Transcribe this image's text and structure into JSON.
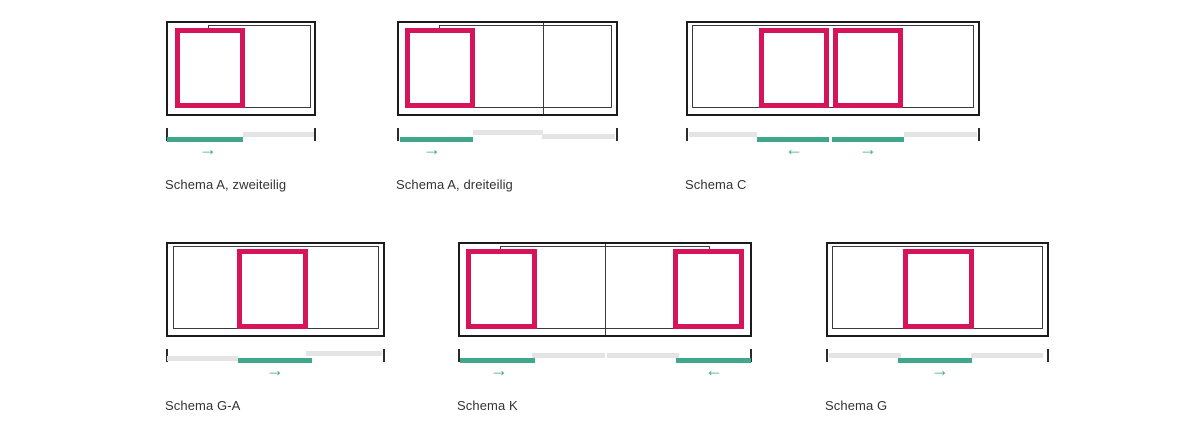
{
  "colors": {
    "panel": "#d6145a",
    "accent": "#40a78c",
    "rail_inactive": "#e4e4e4",
    "frame": "#1b1b1b",
    "outline": "#3b3b3b",
    "tick": "#2b2b2b",
    "label": "#333333",
    "background": "#ffffff"
  },
  "icons": {
    "arrow_right": "→",
    "arrow_left": "←"
  },
  "diagrams": [
    {
      "name": "schema-a-zweiteilig",
      "label": "Schema A, zweiteilig",
      "x": 166,
      "y": 21,
      "width": 150,
      "outline": {
        "x": 40,
        "w": 103
      },
      "dividers": [],
      "panels": [
        {
          "x": 7,
          "w": 70
        }
      ],
      "rails": [
        {
          "state": "active",
          "x": 1,
          "w": 76,
          "dy": 9
        },
        {
          "state": "inactive",
          "x": 77,
          "w": 71,
          "dy": 4
        }
      ],
      "arrows": [
        {
          "dir": "right",
          "cx": 42
        }
      ]
    },
    {
      "name": "schema-a-dreiteilig",
      "label": "Schema A, dreiteilig",
      "x": 397,
      "y": 21,
      "width": 221,
      "outline": {
        "x": 40,
        "w": 173
      },
      "dividers": [
        144
      ],
      "panels": [
        {
          "x": 6,
          "w": 70
        }
      ],
      "rails": [
        {
          "state": "active",
          "x": 3,
          "w": 73,
          "dy": 9
        },
        {
          "state": "inactive",
          "x": 76,
          "w": 70,
          "dy": 2
        },
        {
          "state": "inactive",
          "x": 145,
          "w": 73,
          "dy": 6
        }
      ],
      "arrows": [
        {
          "dir": "right",
          "cx": 35
        }
      ]
    },
    {
      "name": "schema-c",
      "label": "Schema C",
      "x": 686,
      "y": 21,
      "width": 294,
      "outline": {
        "x": 4,
        "w": 282
      },
      "dividers": [],
      "panels": [
        {
          "x": 71,
          "w": 70
        },
        {
          "x": 145,
          "w": 70
        }
      ],
      "rails": [
        {
          "state": "inactive",
          "x": 3,
          "w": 68,
          "dy": 4
        },
        {
          "state": "active",
          "x": 71,
          "w": 72,
          "dy": 9
        },
        {
          "state": "active",
          "x": 146,
          "w": 72,
          "dy": 9
        },
        {
          "state": "inactive",
          "x": 218,
          "w": 73,
          "dy": 4
        }
      ],
      "arrows": [
        {
          "dir": "left",
          "cx": 108
        },
        {
          "dir": "right",
          "cx": 182
        }
      ]
    },
    {
      "name": "schema-g-a",
      "label": "Schema G-A",
      "x": 166,
      "y": 242,
      "width": 219,
      "outline": {
        "x": 5,
        "w": 206
      },
      "dividers": [],
      "panels": [
        {
          "x": 69,
          "w": 71
        }
      ],
      "rails": [
        {
          "state": "inactive",
          "x": 1,
          "w": 71,
          "dy": 7
        },
        {
          "state": "active",
          "x": 72,
          "w": 74,
          "dy": 9
        },
        {
          "state": "inactive",
          "x": 140,
          "w": 76,
          "dy": 2
        }
      ],
      "arrows": [
        {
          "dir": "right",
          "cx": 109
        }
      ]
    },
    {
      "name": "schema-k",
      "label": "Schema K",
      "x": 458,
      "y": 242,
      "width": 294,
      "outline": {
        "x": 40,
        "w": 210
      },
      "dividers": [
        145
      ],
      "panels": [
        {
          "x": 6,
          "w": 71
        },
        {
          "x": 213,
          "w": 71
        }
      ],
      "rails": [
        {
          "state": "active",
          "x": 2,
          "w": 75,
          "dy": 9
        },
        {
          "state": "inactive",
          "x": 74,
          "w": 73,
          "dy": 4
        },
        {
          "state": "inactive",
          "x": 149,
          "w": 72,
          "dy": 4
        },
        {
          "state": "active",
          "x": 218,
          "w": 75,
          "dy": 9
        }
      ],
      "arrows": [
        {
          "dir": "right",
          "cx": 41
        },
        {
          "dir": "left",
          "cx": 256
        }
      ]
    },
    {
      "name": "schema-g",
      "label": "Schema G",
      "x": 826,
      "y": 242,
      "width": 223,
      "outline": {
        "x": 4,
        "w": 211
      },
      "dividers": [],
      "panels": [
        {
          "x": 75,
          "w": 71
        }
      ],
      "rails": [
        {
          "state": "inactive",
          "x": 3,
          "w": 72,
          "dy": 4
        },
        {
          "state": "active",
          "x": 72,
          "w": 74,
          "dy": 9
        },
        {
          "state": "inactive",
          "x": 145,
          "w": 72,
          "dy": 4
        }
      ],
      "arrows": [
        {
          "dir": "right",
          "cx": 114
        }
      ]
    }
  ]
}
